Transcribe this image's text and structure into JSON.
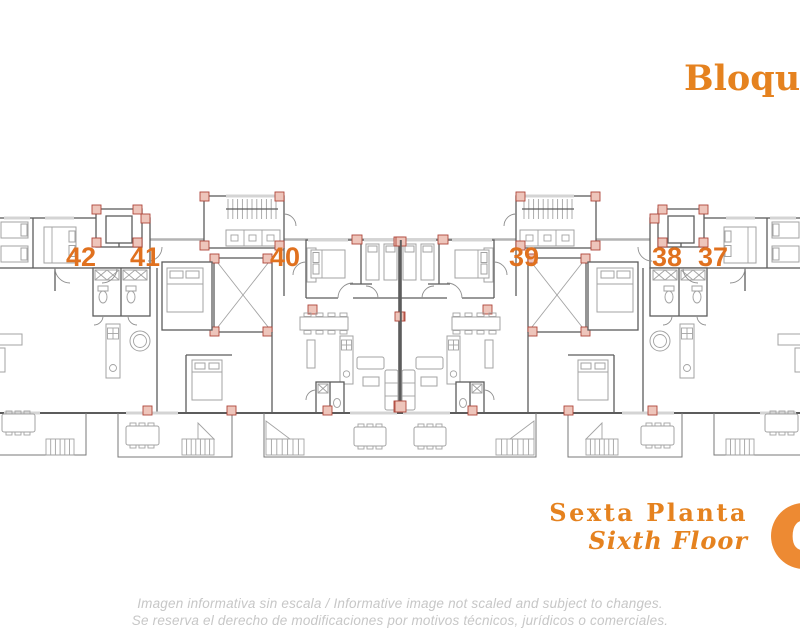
{
  "header": {
    "block_title": "Bloque"
  },
  "plan": {
    "units": [
      {
        "number": "42"
      },
      {
        "number": "41"
      },
      {
        "number": "40"
      },
      {
        "number": "39"
      },
      {
        "number": "38"
      },
      {
        "number": "37"
      }
    ]
  },
  "floor": {
    "name_es": "Sexta Planta",
    "name_en": "Sixth Floor",
    "number": "6"
  },
  "disclaimer": {
    "line1": "Imagen informativa sin escala / Informative image not scaled and subject to changes.",
    "line2": "Se reserva el derecho de modificaciones por motivos técnicos, jurídicos o comerciales."
  },
  "colors": {
    "accent_orange": "#E5821F",
    "number_orange": "#E0711F",
    "badge_orange": "#ED8A33",
    "wall_gray": "#5C5C5C",
    "furniture_gray": "#A3A3A3",
    "corridor_gray": "#B3B3B3",
    "column_red_stroke": "#AE453A",
    "column_red_fill": "#EEC5BB",
    "disclaimer_gray": "#C7C7C7"
  }
}
